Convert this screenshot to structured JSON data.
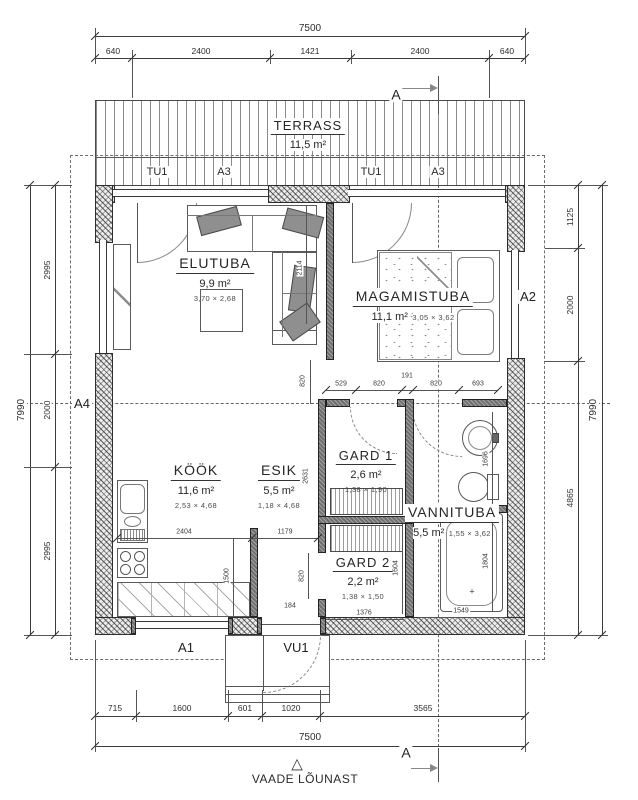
{
  "rooms": {
    "terrass": {
      "name": "TERRASS",
      "area": "11,5 m²"
    },
    "elutuba": {
      "name": "ELUTUBA",
      "area": "9,9 m²",
      "dims": "3,70 × 2,68"
    },
    "magamistuba": {
      "name": "MAGAMISTUBA",
      "area": "11,1 m²",
      "dims": "3,05 × 3,62"
    },
    "kook": {
      "name": "KÖÖK",
      "area": "11,6 m²",
      "dims": "2,53 × 4,68"
    },
    "esik": {
      "name": "ESIK",
      "area": "5,5 m²",
      "dims": "1,18 × 4,68"
    },
    "gard1": {
      "name": "GARD 1",
      "area": "2,6 m²",
      "dims": "1,38 × 1,90"
    },
    "gard2": {
      "name": "GARD 2",
      "area": "2,2 m²",
      "dims": "1,38 × 1,50"
    },
    "vannituba": {
      "name": "VANNITUBA",
      "area": "5,5 m²",
      "dims": "1,55 × 3,62"
    }
  },
  "markers": {
    "section_top": "A",
    "section_bottom": "A",
    "a1": "A1",
    "a2": "A2",
    "a3_left": "A3",
    "a3_right": "A3",
    "a4": "A4",
    "tu1_left": "TU1",
    "tu1_right": "TU1",
    "vu1": "VU1"
  },
  "view": {
    "label": "VAADE LÕUNAST"
  },
  "icons": {
    "view_triangle": "△"
  },
  "dims": {
    "top": {
      "total": "7500",
      "segments": [
        "640",
        "2400",
        "1421",
        "2400",
        "640"
      ]
    },
    "bottom": {
      "total": "7500",
      "segments": [
        "715",
        "1600",
        "601",
        "1020",
        "3565"
      ]
    },
    "left": {
      "total": "7990",
      "segments": [
        "2995",
        "2000",
        "2995"
      ]
    },
    "right": {
      "total": "7990",
      "segments": [
        "1125",
        "2000",
        "4865"
      ]
    },
    "interior": [
      "2404",
      "1179",
      "1500",
      "820",
      "184",
      "1376",
      "1549",
      "1696",
      "1804",
      "1604",
      "2631",
      "2114",
      "820",
      "529",
      "820",
      "191",
      "820",
      "693"
    ]
  },
  "colors": {
    "line": "#3d3d3d",
    "wall_fill": "#ececec",
    "interior_wall": "#6f6f6f"
  }
}
